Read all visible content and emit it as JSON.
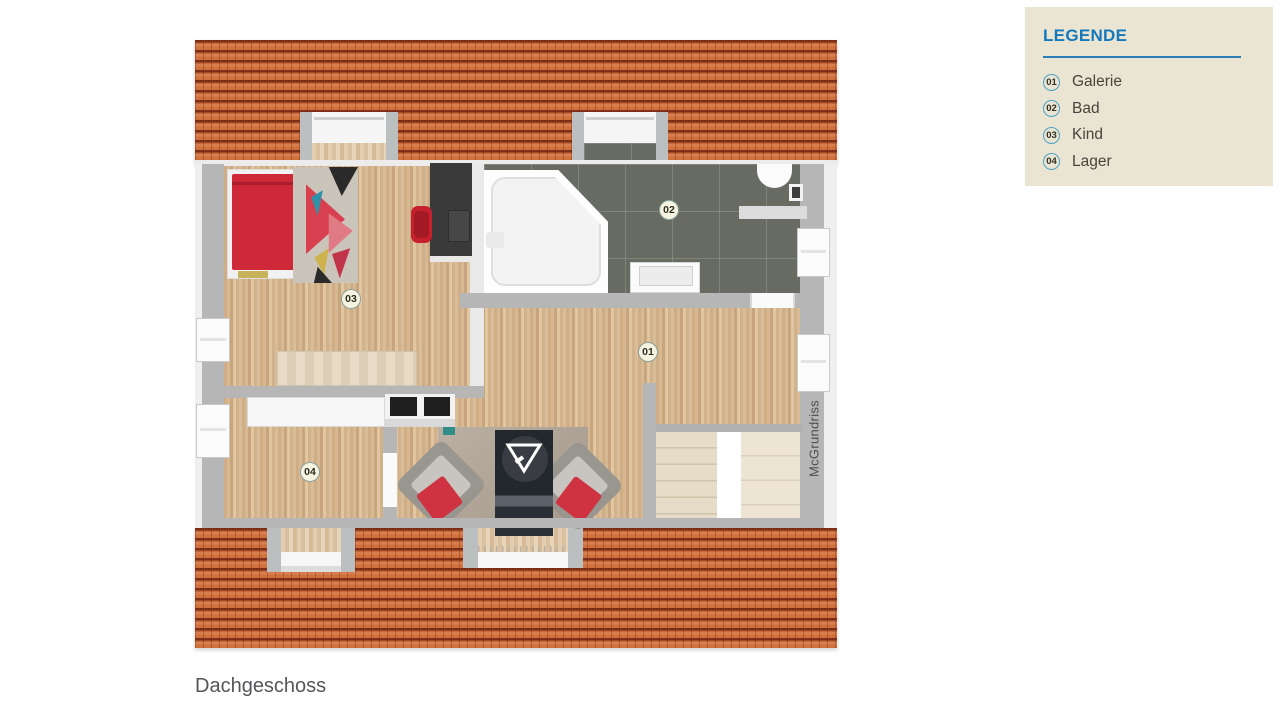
{
  "plan": {
    "caption": "Dachgeschoss",
    "watermark": "McGrundriss",
    "room_labels": {
      "galerie": "01",
      "bad": "02",
      "kind": "03",
      "lager": "04"
    }
  },
  "legend": {
    "title": "LEGENDE",
    "items": [
      {
        "num": "01",
        "label": "Galerie"
      },
      {
        "num": "02",
        "label": "Bad"
      },
      {
        "num": "03",
        "label": "Kind"
      },
      {
        "num": "04",
        "label": "Lager"
      }
    ]
  },
  "colors": {
    "legend_bg": "#eae5d2",
    "legend_accent": "#1478bd",
    "legend_circle_border": "#4ba1c4",
    "roof_tile": "#d0703c",
    "roof_dark_band": "#7d2e17",
    "wall_gray": "#b6b6b6",
    "wood_floor": "#d4b892",
    "bathroom_tile": "#676b62",
    "bed_red": "#cf2839",
    "stairs_beige": "#e6dcc8"
  }
}
